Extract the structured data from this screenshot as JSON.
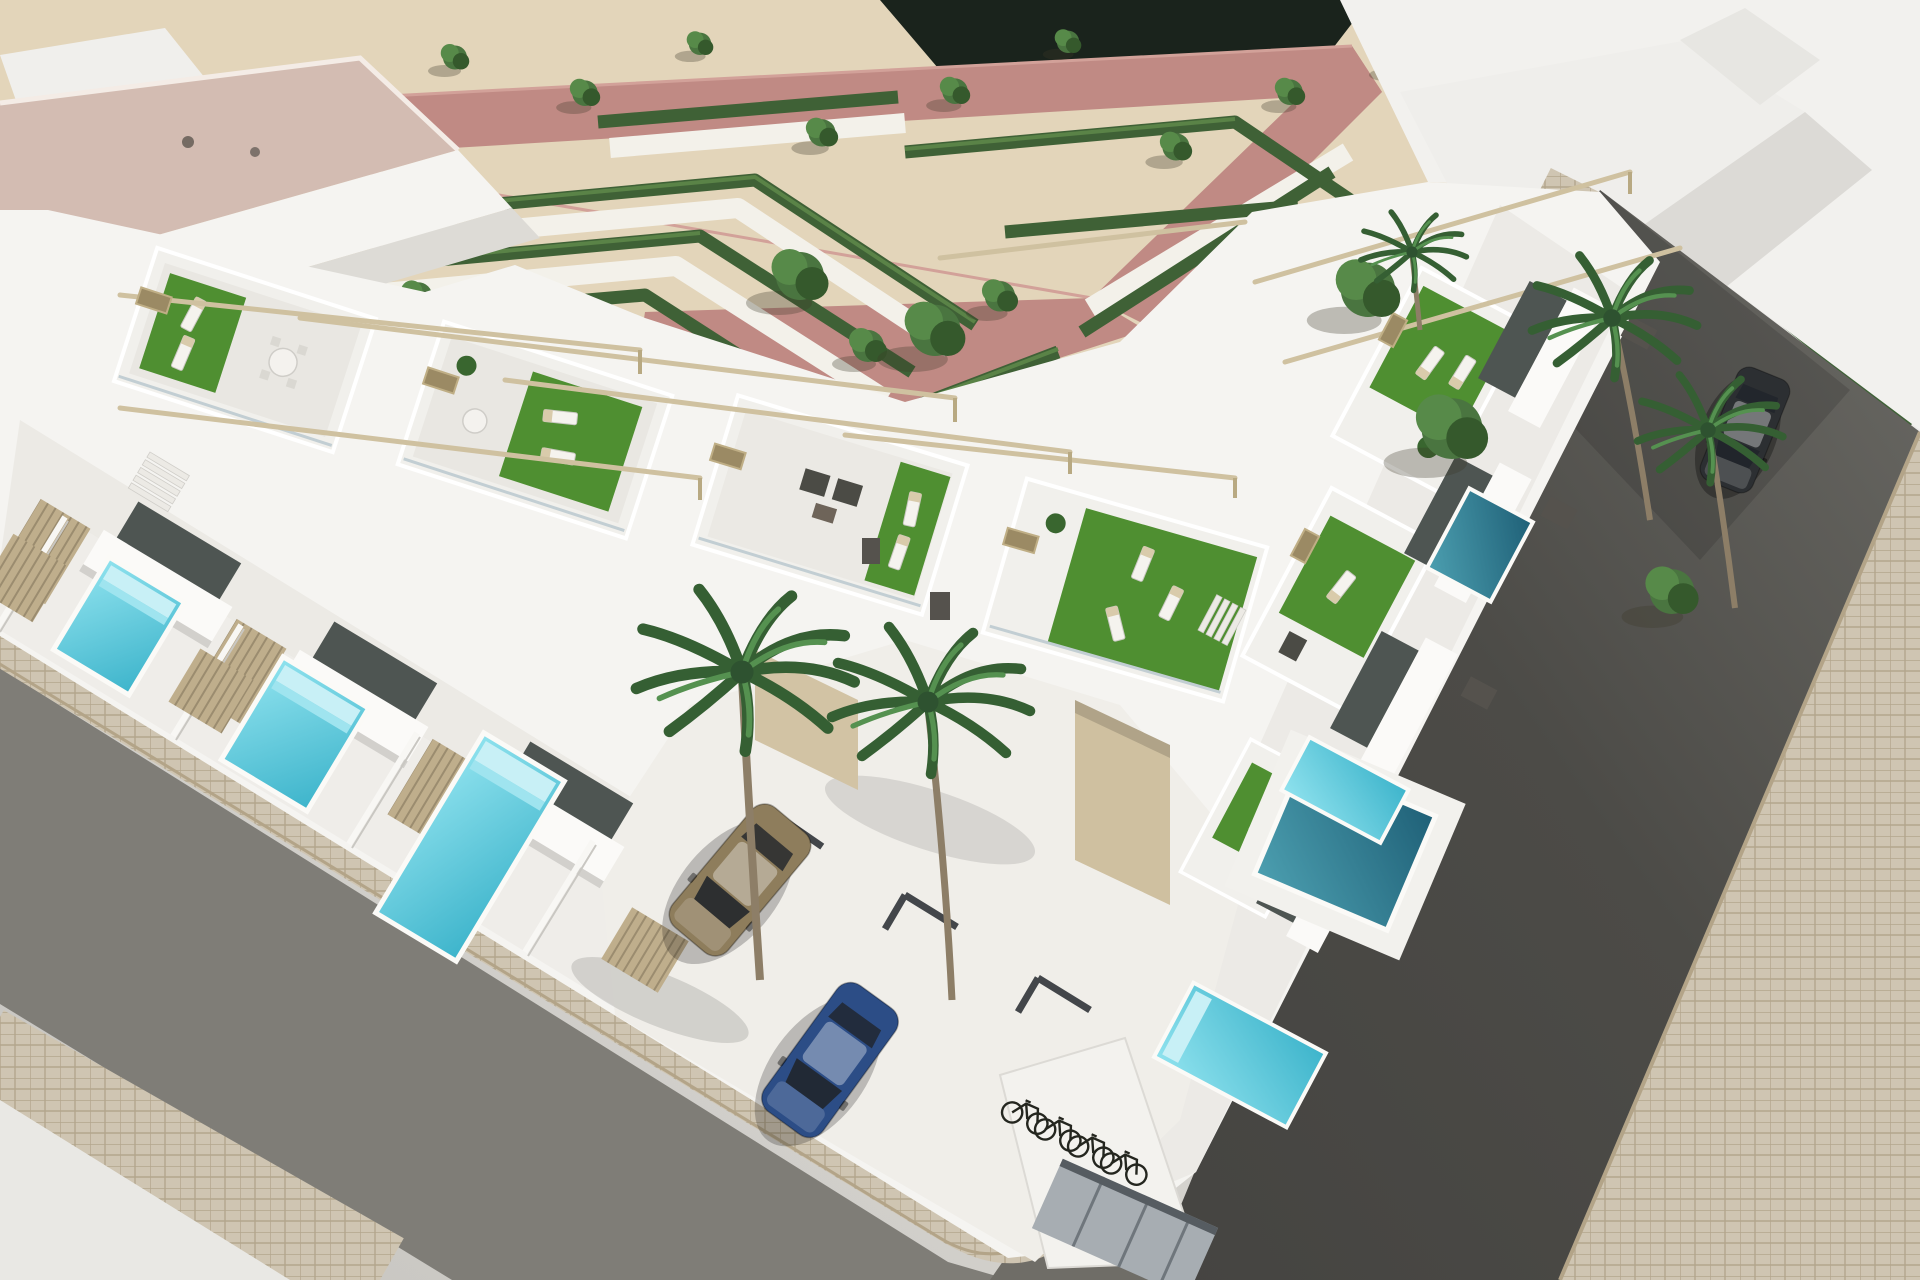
{
  "scene": {
    "title": "Aerial 3D render of a modern white townhouse development on a street corner",
    "type": "architectural-3d-render",
    "view": "aerial corner perspective, midday sun with hard shadows",
    "park": {
      "ground": "sand gravel",
      "paths": [
        "pink walkways",
        "white gravel paths"
      ],
      "hedge_style": "low clipped zigzag parterre hedges",
      "tree_count": 20
    },
    "buildings": {
      "style": "modern white cubic two-storey townhouses",
      "roof_terraces": 7,
      "terrace_features": [
        "artificial turf",
        "sun loungers",
        "rattan sofa sets",
        "dining sets",
        "pergola beams",
        "glass balustrades",
        "tan slat cladding"
      ]
    },
    "pools": {
      "count": 7,
      "types": [
        "bright turquoise plunge pools with steps",
        "deep teal pools"
      ]
    },
    "vehicles": [
      {
        "name": "gold-suv",
        "color": "#8e7d5c"
      },
      {
        "name": "blue-hatchback",
        "color": "#2c4d86"
      },
      {
        "name": "dark-car",
        "color": "#2c2f32"
      }
    ],
    "bicycle_count": 4,
    "palm_tree_count": 5,
    "streets": {
      "left": "light grey asphalt with beige paver sidewalks",
      "right": "dark asphalt descending to corner",
      "corner": "rounded paver sidewalk corner"
    }
  },
  "colors": {
    "sand": "#e3d5ba",
    "dark_band": "#1a231c",
    "path_pink": "#c08a84",
    "path_pink_light": "#d2a199",
    "path_white": "#f3f1ea",
    "hedge": "#3f6136",
    "hedge_light": "#5a8347",
    "turf": "#4f8f31",
    "roof_pink": "#d3bcb2",
    "building_white": "#f5f4f1",
    "building_mid": "#eceae5",
    "building_shade": "#dddbd6",
    "building_dark": "#c4c2bd",
    "window": "#4e5552",
    "slat": "#bfae8c",
    "slat_line": "#9b8c6f",
    "pergola": "#cfc1a0",
    "tan_door": "#cfc0a0",
    "pool_light_a": "#8fe2ee",
    "pool_light_b": "#3db4cb",
    "pool_deep_a": "#4c9fb0",
    "pool_deep_b": "#1f6077",
    "asphalt_left": "#7f7d77",
    "asphalt_right": "#4c4b47",
    "paver": "#cfc5b2",
    "paver_line": "#b3a68c",
    "plaza": "#e9e8e4",
    "bike": "#24261f",
    "shed": "#a7adb2"
  }
}
